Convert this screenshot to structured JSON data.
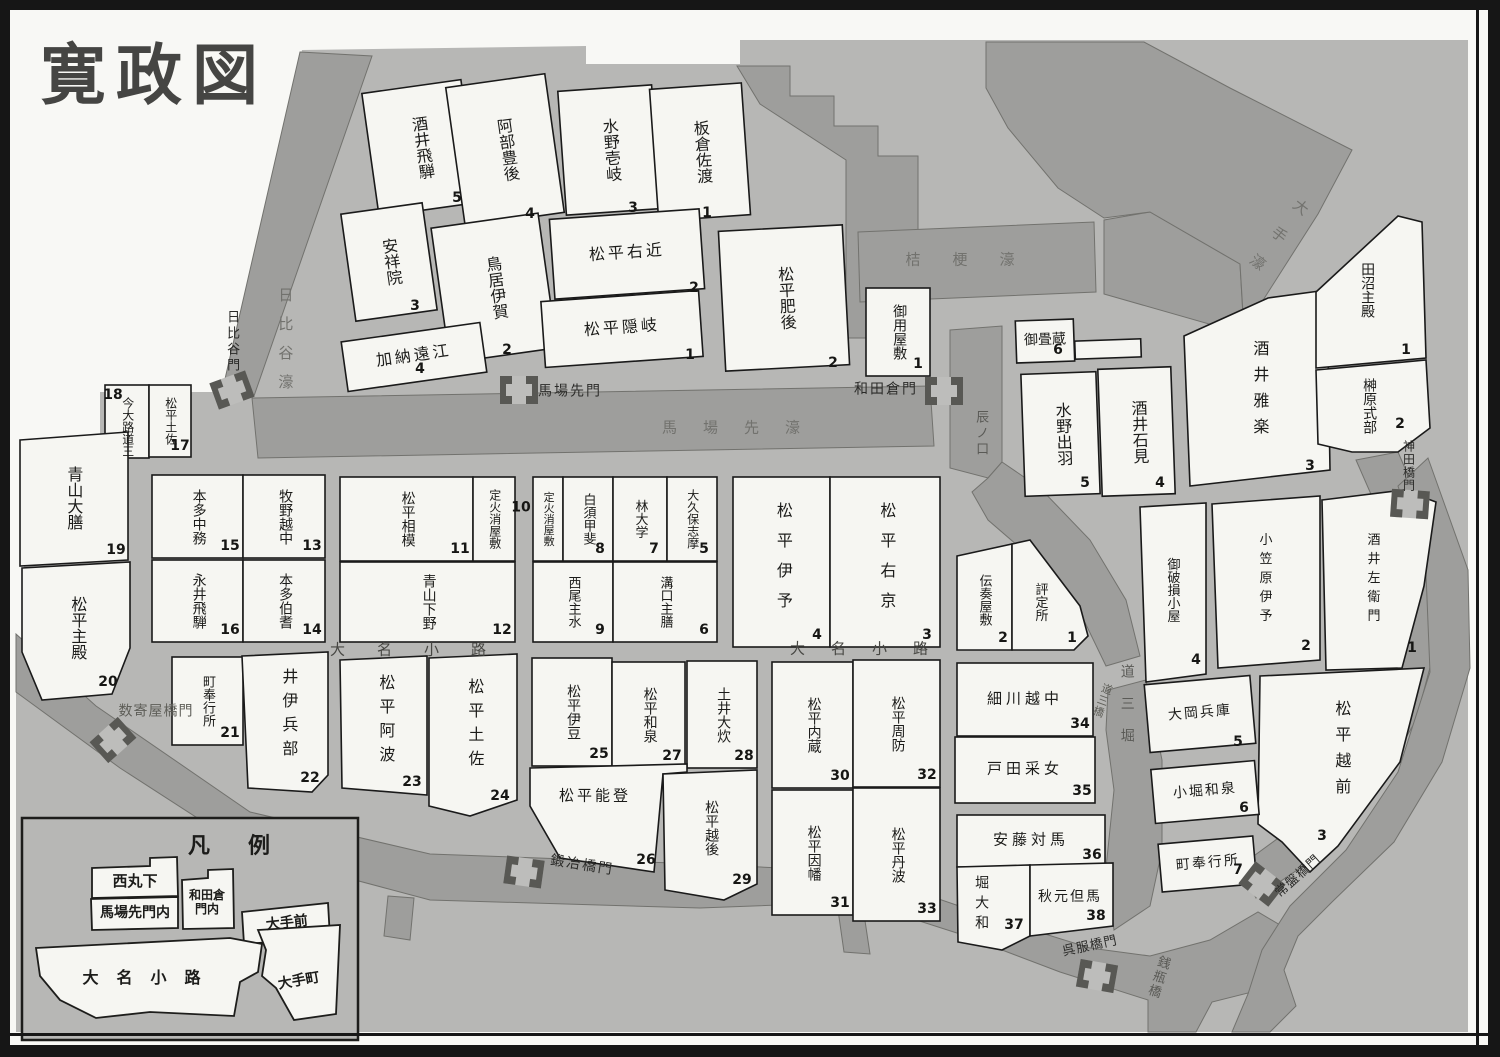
{
  "title": "寛政図",
  "colors": {
    "paper": "#f8f8f5",
    "city": "#b7b7b5",
    "moat": "#9e9e9c",
    "block": "#f6f6f2",
    "line": "#1a1a1a"
  },
  "legend": {
    "title": "凡例",
    "items": [
      {
        "label": "西丸下"
      },
      {
        "label": "馬場先門内"
      },
      {
        "label": "和田倉門内"
      },
      {
        "label": "大手前"
      },
      {
        "label": "大名小路"
      },
      {
        "label": "大手町"
      }
    ]
  },
  "blocks": [
    {
      "id": "sakai-hida",
      "label": "酒井飛騨",
      "num": "5",
      "x": 370,
      "y": 86,
      "w": 100,
      "h": 124,
      "rot": -8
    },
    {
      "id": "abe-bungo",
      "label": "阿部豊後",
      "num": "4",
      "x": 455,
      "y": 80,
      "w": 100,
      "h": 140,
      "rot": -8,
      "nx": 530,
      "ny": 214
    },
    {
      "id": "ansho-in",
      "label": "安祥院",
      "num": "3",
      "x": 348,
      "y": 208,
      "w": 82,
      "h": 108,
      "rot": -8,
      "nx": 415,
      "ny": 306
    },
    {
      "id": "torii-iga",
      "label": "鳥居伊賀",
      "num": "2",
      "x": 440,
      "y": 220,
      "w": 108,
      "h": 136,
      "rot": -8,
      "nx": 507,
      "ny": 350
    },
    {
      "id": "kano-totomi",
      "label": "加納遠江",
      "num": "4",
      "dir": "h",
      "x": 344,
      "y": 332,
      "w": 140,
      "h": 50,
      "rot": -8,
      "nx": 420,
      "ny": 369,
      "ls": 3
    },
    {
      "id": "mizuno-iki",
      "label": "水野壱岐",
      "num": "3",
      "x": 562,
      "y": 88,
      "w": 94,
      "h": 124,
      "rot": -4,
      "nx": 633,
      "ny": 208
    },
    {
      "id": "itakura-sado",
      "label": "板倉佐渡",
      "num": "1",
      "x": 654,
      "y": 86,
      "w": 92,
      "h": 132,
      "rot": -4,
      "nx": 707,
      "ny": 213
    },
    {
      "id": "matsudaira-ukon",
      "label": "松平右近",
      "num": "2",
      "dir": "h",
      "x": 552,
      "y": 214,
      "w": 150,
      "h": 80,
      "rot": -4,
      "nx": 694,
      "ny": 288,
      "ls": 3
    },
    {
      "id": "matsudaira-oki",
      "label": "松平隠岐",
      "num": "1",
      "dir": "h",
      "x": 543,
      "y": 296,
      "w": 158,
      "h": 66,
      "rot": -4,
      "nx": 690,
      "ny": 355,
      "ls": 3
    },
    {
      "id": "matsudaira-higo",
      "label": "松平肥後",
      "num": "2",
      "x": 722,
      "y": 228,
      "w": 124,
      "h": 140,
      "rot": -3,
      "nx": 833,
      "ny": 363
    },
    {
      "id": "goyo-yashiki",
      "label": "御用屋敷",
      "num": "1",
      "x": 866,
      "y": 288,
      "w": 64,
      "h": 88,
      "fs": 14,
      "nx": 918,
      "ny": 364
    },
    {
      "id": "otatami-gura",
      "label": "御畳蔵",
      "num": "6",
      "dir": "h",
      "x": 1016,
      "y": 320,
      "w": 58,
      "h": 42,
      "fs": 14,
      "rot": -2,
      "nx": 1058,
      "ny": 350
    },
    {
      "id": "kura-strip",
      "x": 1075,
      "y": 340,
      "w": 66,
      "h": 18,
      "rot": -2
    },
    {
      "id": "mizuno-dewa",
      "label": "水野出羽",
      "num": "5",
      "x": 1023,
      "y": 373,
      "w": 75,
      "h": 122,
      "rot": -2
    },
    {
      "id": "sakai-iwami",
      "label": "酒井石見",
      "num": "4",
      "x": 1100,
      "y": 368,
      "w": 73,
      "h": 127,
      "rot": -2
    },
    {
      "id": "sakai-uta",
      "label": "酒井雅楽",
      "num": "3",
      "pts": "1184,336 1268,298 1327,290 1330,470 1190,486",
      "cx": 1258,
      "cy": 392,
      "nx": 1310,
      "ny": 466,
      "ls": 10
    },
    {
      "id": "tanuma-tonomo",
      "label": "田沼主殿",
      "num": "1",
      "pts": "1316,292 1398,216 1422,222 1426,358 1316,368",
      "cx": 1366,
      "cy": 290,
      "nx": 1406,
      "ny": 350,
      "fs": 14
    },
    {
      "id": "sakakibara-shikibu",
      "label": "榊原式部",
      "num": "2",
      "pts": "1316,370 1426,360 1430,428 1398,452 1352,452 1318,444",
      "cx": 1368,
      "cy": 406,
      "nx": 1400,
      "ny": 424,
      "fs": 14
    },
    {
      "id": "imaoji-dosan",
      "label": "今大路道三",
      "num": "18",
      "x": 105,
      "y": 385,
      "w": 44,
      "h": 73,
      "fs": 12,
      "lh": 50,
      "nx": 113,
      "ny": 395
    },
    {
      "id": "matsudaira-tosa-n17",
      "label": "松平土佐",
      "num": "17",
      "x": 149,
      "y": 385,
      "w": 42,
      "h": 72,
      "fs": 12,
      "nx": 180,
      "ny": 446
    },
    {
      "id": "aoyama-daizen",
      "label": "青山大膳",
      "num": "19",
      "pts": "20,440 128,432 128,560 20,566",
      "cx": 72,
      "cy": 498,
      "nx": 116,
      "ny": 550
    },
    {
      "id": "matsudaira-tonomo-n20",
      "label": "松平主殿",
      "num": "20",
      "pts": "22,568 130,562 130,648 112,694 42,700 22,652",
      "cx": 76,
      "cy": 628,
      "nx": 108,
      "ny": 682
    },
    {
      "id": "honda-nakatsukasa",
      "label": "本多中務",
      "num": "15",
      "x": 152,
      "y": 475,
      "w": 91,
      "h": 83,
      "fs": 14
    },
    {
      "id": "makino-etchu",
      "label": "牧野越中",
      "num": "13",
      "x": 243,
      "y": 475,
      "w": 82,
      "h": 83,
      "fs": 14
    },
    {
      "id": "matsudaira-sagami",
      "label": "松平相模",
      "num": "11",
      "x": 340,
      "y": 477,
      "w": 133,
      "h": 84,
      "fs": 14
    },
    {
      "id": "jobikeshi-yashiki-w",
      "label": "定火消屋敷",
      "x": 473,
      "y": 477,
      "w": 42,
      "h": 84,
      "fs": 12
    },
    {
      "id": "jobikeshi-yashiki-e",
      "label": "定火消屋敷",
      "x": 533,
      "y": 477,
      "w": 30,
      "h": 84,
      "fs": 11
    },
    {
      "id": "shirasu-kai",
      "label": "白須甲斐",
      "num": "8",
      "x": 563,
      "y": 477,
      "w": 50,
      "h": 84,
      "fs": 13
    },
    {
      "id": "hayashi-daigaku",
      "label": "林大学",
      "num": "7",
      "x": 613,
      "y": 477,
      "w": 54,
      "h": 84,
      "fs": 13
    },
    {
      "id": "okubo-shima",
      "label": "大久保志摩",
      "num": "5",
      "x": 667,
      "y": 477,
      "w": 50,
      "h": 84,
      "fs": 12
    },
    {
      "id": "nagai-hida",
      "label": "永井飛騨",
      "num": "16",
      "x": 152,
      "y": 560,
      "w": 91,
      "h": 82,
      "fs": 14
    },
    {
      "id": "honda-hoki",
      "label": "本多伯耆",
      "num": "14",
      "x": 243,
      "y": 560,
      "w": 82,
      "h": 82,
      "fs": 14
    },
    {
      "id": "aoyama-shimotsuke",
      "label": "青山下野",
      "num": "12",
      "x": 340,
      "y": 562,
      "w": 175,
      "h": 80,
      "fs": 14
    },
    {
      "id": "nishio-mondo",
      "label": "西尾主水",
      "num": "9",
      "x": 533,
      "y": 562,
      "w": 80,
      "h": 80,
      "fs": 13
    },
    {
      "id": "mizoguchi-shuzen",
      "label": "溝口主膳",
      "num": "6",
      "x": 613,
      "y": 562,
      "w": 104,
      "h": 80,
      "fs": 13
    },
    {
      "id": "matsudaira-iyo",
      "label": "松平伊予",
      "num": "4",
      "x": 733,
      "y": 477,
      "w": 97,
      "h": 170,
      "ls": 14
    },
    {
      "id": "matsudaira-ukyo",
      "label": "松平右京",
      "num": "3",
      "x": 830,
      "y": 477,
      "w": 110,
      "h": 170,
      "ls": 14
    },
    {
      "id": "denso-yashiki",
      "label": "伝奏屋敷",
      "num": "2",
      "pts": "957,556 1012,544 1012,650 957,650",
      "cx": 984,
      "cy": 600,
      "nx": 1003,
      "ny": 638,
      "fs": 13
    },
    {
      "id": "hyojosho",
      "label": "評定所",
      "num": "1",
      "pts": "1012,544 1030,540 1080,606 1088,636 1074,650 1012,650",
      "cx": 1040,
      "cy": 602,
      "nx": 1072,
      "ny": 638,
      "fs": 13
    },
    {
      "id": "gohason-goya",
      "label": "御破損小屋",
      "num": "4",
      "pts": "1140,507 1206,503 1206,674 1146,682",
      "cx": 1172,
      "cy": 590,
      "nx": 1196,
      "ny": 660,
      "fs": 13
    },
    {
      "id": "ogasawara-iyo",
      "label": "小笠原伊予",
      "num": "2",
      "pts": "1212,504 1320,496 1320,660 1218,668",
      "cx": 1264,
      "cy": 580,
      "nx": 1306,
      "ny": 646,
      "fs": 13,
      "ls": 6
    },
    {
      "id": "sakai-saemon",
      "label": "酒井左衛門",
      "num": "1",
      "pts": "1322,500 1404,490 1436,502 1424,586 1402,668 1326,670",
      "cx": 1372,
      "cy": 580,
      "nx": 1412,
      "ny": 648,
      "fs": 13,
      "ls": 6
    },
    {
      "id": "matsudaira-echizen",
      "label": "松平越前",
      "num": "3",
      "pts": "1260,676 1424,668 1400,762 1338,846 1310,872 1282,842 1258,824",
      "cx": 1340,
      "cy": 752,
      "nx": 1322,
      "ny": 836,
      "ls": 10
    },
    {
      "id": "machibugyosho-21",
      "label": "町奉行所",
      "num": "21",
      "x": 172,
      "y": 657,
      "w": 71,
      "h": 88,
      "fs": 13
    },
    {
      "id": "ii-hyobu",
      "label": "井伊兵部",
      "num": "22",
      "pts": "242,656 328,652 328,775 312,792 248,788",
      "cx": 287,
      "cy": 716,
      "nx": 310,
      "ny": 778,
      "ls": 8
    },
    {
      "id": "matsudaira-awa",
      "label": "松平阿波",
      "num": "23",
      "pts": "340,660 427,656 427,795 342,788",
      "cx": 384,
      "cy": 722,
      "nx": 412,
      "ny": 782,
      "ls": 8
    },
    {
      "id": "matsudaira-tosa-n24",
      "label": "松平土佐",
      "num": "24",
      "pts": "429,658 517,654 517,800 470,816 429,806",
      "cx": 473,
      "cy": 726,
      "nx": 500,
      "ny": 796,
      "ls": 8
    },
    {
      "id": "matsudaira-izu",
      "label": "松平伊豆",
      "num": "25",
      "x": 532,
      "y": 658,
      "w": 80,
      "h": 108,
      "fs": 14
    },
    {
      "id": "matsudaira-izumi",
      "label": "松平和泉",
      "num": "27",
      "x": 612,
      "y": 662,
      "w": 73,
      "h": 106,
      "fs": 14
    },
    {
      "id": "doi-oi",
      "label": "土井大炊",
      "num": "28",
      "x": 687,
      "y": 661,
      "w": 70,
      "h": 107,
      "fs": 14
    },
    {
      "id": "matsudaira-noto",
      "label": "松平能登",
      "num": "26",
      "dir": "h",
      "pts": "530,768 687,764 687,772 663,774 654,872 560,858 530,806",
      "cx": 595,
      "cy": 797,
      "nx": 646,
      "ny": 860,
      "fs": 15,
      "ls": 3
    },
    {
      "id": "matsudaira-echigo",
      "label": "松平越後",
      "num": "29",
      "pts": "663,774 757,770 757,884 724,900 665,890",
      "cx": 710,
      "cy": 828,
      "nx": 742,
      "ny": 880,
      "fs": 14
    },
    {
      "id": "matsudaira-kura",
      "label": "松平内蔵",
      "num": "30",
      "x": 772,
      "y": 662,
      "w": 81,
      "h": 126,
      "fs": 14
    },
    {
      "id": "matsudaira-suo",
      "label": "松平周防",
      "num": "32",
      "x": 853,
      "y": 660,
      "w": 87,
      "h": 127,
      "fs": 14
    },
    {
      "id": "matsudaira-inaba",
      "label": "松平因幡",
      "num": "31",
      "x": 772,
      "y": 790,
      "w": 81,
      "h": 125,
      "fs": 14
    },
    {
      "id": "matsudaira-tanba",
      "label": "松平丹波",
      "num": "33",
      "x": 853,
      "y": 788,
      "w": 87,
      "h": 133,
      "fs": 14
    },
    {
      "id": "hosokawa-etchu",
      "label": "細川越中",
      "num": "34",
      "dir": "h",
      "x": 957,
      "y": 663,
      "w": 136,
      "h": 73,
      "fs": 15,
      "ls": 4
    },
    {
      "id": "toda-uneme",
      "label": "戸田采女",
      "num": "35",
      "dir": "h",
      "x": 955,
      "y": 737,
      "w": 140,
      "h": 66,
      "fs": 15,
      "ls": 4
    },
    {
      "id": "ando-tsushima",
      "label": "安藤対馬",
      "num": "36",
      "dir": "h",
      "x": 957,
      "y": 815,
      "w": 148,
      "h": 52,
      "fs": 15,
      "ls": 4
    },
    {
      "id": "hori-yamato",
      "label": "堀大和",
      "num": "37",
      "pts": "957,867 1030,865 1030,936 1002,950 958,942",
      "cx": 980,
      "cy": 905,
      "nx": 1014,
      "ny": 925,
      "fs": 14,
      "ls": 6
    },
    {
      "id": "akimoto-tajima",
      "label": "秋元但馬",
      "num": "38",
      "dir": "h",
      "pts": "1030,865 1113,863 1113,926 1030,936",
      "cx": 1070,
      "cy": 898,
      "nx": 1096,
      "ny": 916,
      "fs": 14,
      "ls": 2
    },
    {
      "id": "ooka-hyogo",
      "label": "大岡兵庫",
      "num": "5",
      "dir": "h",
      "x": 1147,
      "y": 680,
      "w": 106,
      "h": 68,
      "fs": 14,
      "rot": -5,
      "ls": 2,
      "nx": 1238,
      "ny": 742
    },
    {
      "id": "kobori-izumi",
      "label": "小堀和泉",
      "num": "6",
      "dir": "h",
      "x": 1153,
      "y": 765,
      "w": 104,
      "h": 54,
      "fs": 14,
      "rot": -5,
      "ls": 2,
      "nx": 1244,
      "ny": 808
    },
    {
      "id": "machibugyosho-7",
      "label": "町奉行所",
      "num": "7",
      "dir": "h",
      "x": 1160,
      "y": 840,
      "w": 95,
      "h": 48,
      "fs": 14,
      "rot": -5,
      "ls": 2,
      "nx": 1238,
      "ny": 870
    }
  ],
  "labels": [
    {
      "id": "hibiya-moat-label",
      "t": "日比谷濠",
      "x": 284,
      "y": 345,
      "dir": "v",
      "fs": 15,
      "ls": 14,
      "c": "moat"
    },
    {
      "id": "hibiya-gate-label",
      "t": "日比谷門",
      "x": 232,
      "y": 342,
      "dir": "v",
      "fs": 13,
      "ls": 3,
      "c": "gate"
    },
    {
      "id": "babasaki-moat-label",
      "t": "馬場先濠",
      "x": 744,
      "y": 429,
      "dir": "h",
      "fs": 15,
      "ls": 26,
      "c": "moat"
    },
    {
      "id": "babasaki-gate-label",
      "t": "馬場先門",
      "x": 570,
      "y": 392,
      "dir": "h",
      "fs": 14,
      "ls": 2,
      "c": "gate"
    },
    {
      "id": "wadakura-gate-label",
      "t": "和田倉門",
      "x": 886,
      "y": 390,
      "dir": "h",
      "fs": 14,
      "ls": 2,
      "c": "gate"
    },
    {
      "id": "kikyo-moat-label",
      "t": "桔梗濠",
      "x": 976,
      "y": 261,
      "dir": "h",
      "fs": 15,
      "ls": 32,
      "c": "moat"
    },
    {
      "id": "ote-moat-label",
      "t": "大手濠",
      "x": 1272,
      "y": 241,
      "dir": "v",
      "fs": 15,
      "ls": 20,
      "rot": 38,
      "c": "moat"
    },
    {
      "id": "tatsunokuchi-label",
      "t": "辰ノ口",
      "x": 981,
      "y": 434,
      "dir": "v",
      "fs": 13,
      "ls": 3,
      "c": "moat2"
    },
    {
      "id": "kanda-gate-label",
      "t": "神田橋門",
      "x": 1408,
      "y": 466,
      "dir": "v",
      "fs": 12,
      "ls": 1,
      "lh": 52,
      "c": "gate"
    },
    {
      "id": "daimyo-koji-west",
      "t": "大名小路",
      "x": 424,
      "y": 651,
      "dir": "h",
      "fs": 15,
      "ls": 32,
      "c": "street"
    },
    {
      "id": "daimyo-koji-east",
      "t": "大名小路",
      "x": 872,
      "y": 650,
      "dir": "h",
      "fs": 15,
      "ls": 26,
      "c": "street"
    },
    {
      "id": "block-10-number",
      "t": "10",
      "x": 521,
      "y": 508,
      "dir": "h",
      "fs": 14,
      "c": "num"
    },
    {
      "id": "sukiyabashi-gate-label",
      "t": "数寄屋橋門",
      "x": 156,
      "y": 712,
      "dir": "h",
      "fs": 14,
      "ls": 1,
      "c": "gate2"
    },
    {
      "id": "kajibashi-gate-label",
      "t": "鍛冶橋門",
      "x": 582,
      "y": 866,
      "dir": "h",
      "fs": 14,
      "ls": 2,
      "rot": 9,
      "c": "gate"
    },
    {
      "id": "gofukubashi-gate-label",
      "t": "呉服橋門",
      "x": 1090,
      "y": 946,
      "dir": "h",
      "fs": 13,
      "ls": 1,
      "rot": -12,
      "c": "gate"
    },
    {
      "id": "tokiwabashi-gate-label",
      "t": "常盤橋門",
      "x": 1298,
      "y": 876,
      "dir": "h",
      "fs": 13,
      "ls": 1,
      "rot": -42,
      "c": "gate"
    },
    {
      "id": "zenigame-bashi-label",
      "t": "銭瓶橋",
      "x": 1158,
      "y": 977,
      "dir": "v",
      "fs": 13,
      "ls": 2,
      "rot": 18,
      "c": "moat2"
    },
    {
      "id": "dosan-bori-label",
      "t": "道三堀",
      "x": 1126,
      "y": 712,
      "dir": "v",
      "fs": 14,
      "ls": 18,
      "c": "moat2"
    },
    {
      "id": "dosan-bashi-label",
      "t": "道三橋",
      "x": 1101,
      "y": 700,
      "dir": "v",
      "fs": 11,
      "ls": 1,
      "rot": 20,
      "c": "gate2"
    }
  ],
  "gates": [
    {
      "id": "hibiya-gate",
      "x": 232,
      "y": 390,
      "rot": -20
    },
    {
      "id": "babasaki-gate",
      "x": 519,
      "y": 390,
      "rot": 0
    },
    {
      "id": "wadakura-gate",
      "x": 944,
      "y": 391,
      "rot": 0
    },
    {
      "id": "sukiyabashi-gate",
      "x": 113,
      "y": 740,
      "rot": -42
    },
    {
      "id": "kajibashi-gate",
      "x": 524,
      "y": 872,
      "rot": 8
    },
    {
      "id": "gofukubashi-gate",
      "x": 1097,
      "y": 976,
      "rot": 10
    },
    {
      "id": "tokiwabashi-gate",
      "x": 1262,
      "y": 884,
      "rot": 38
    },
    {
      "id": "kandabashi-gate",
      "x": 1410,
      "y": 504,
      "rot": 4
    }
  ]
}
